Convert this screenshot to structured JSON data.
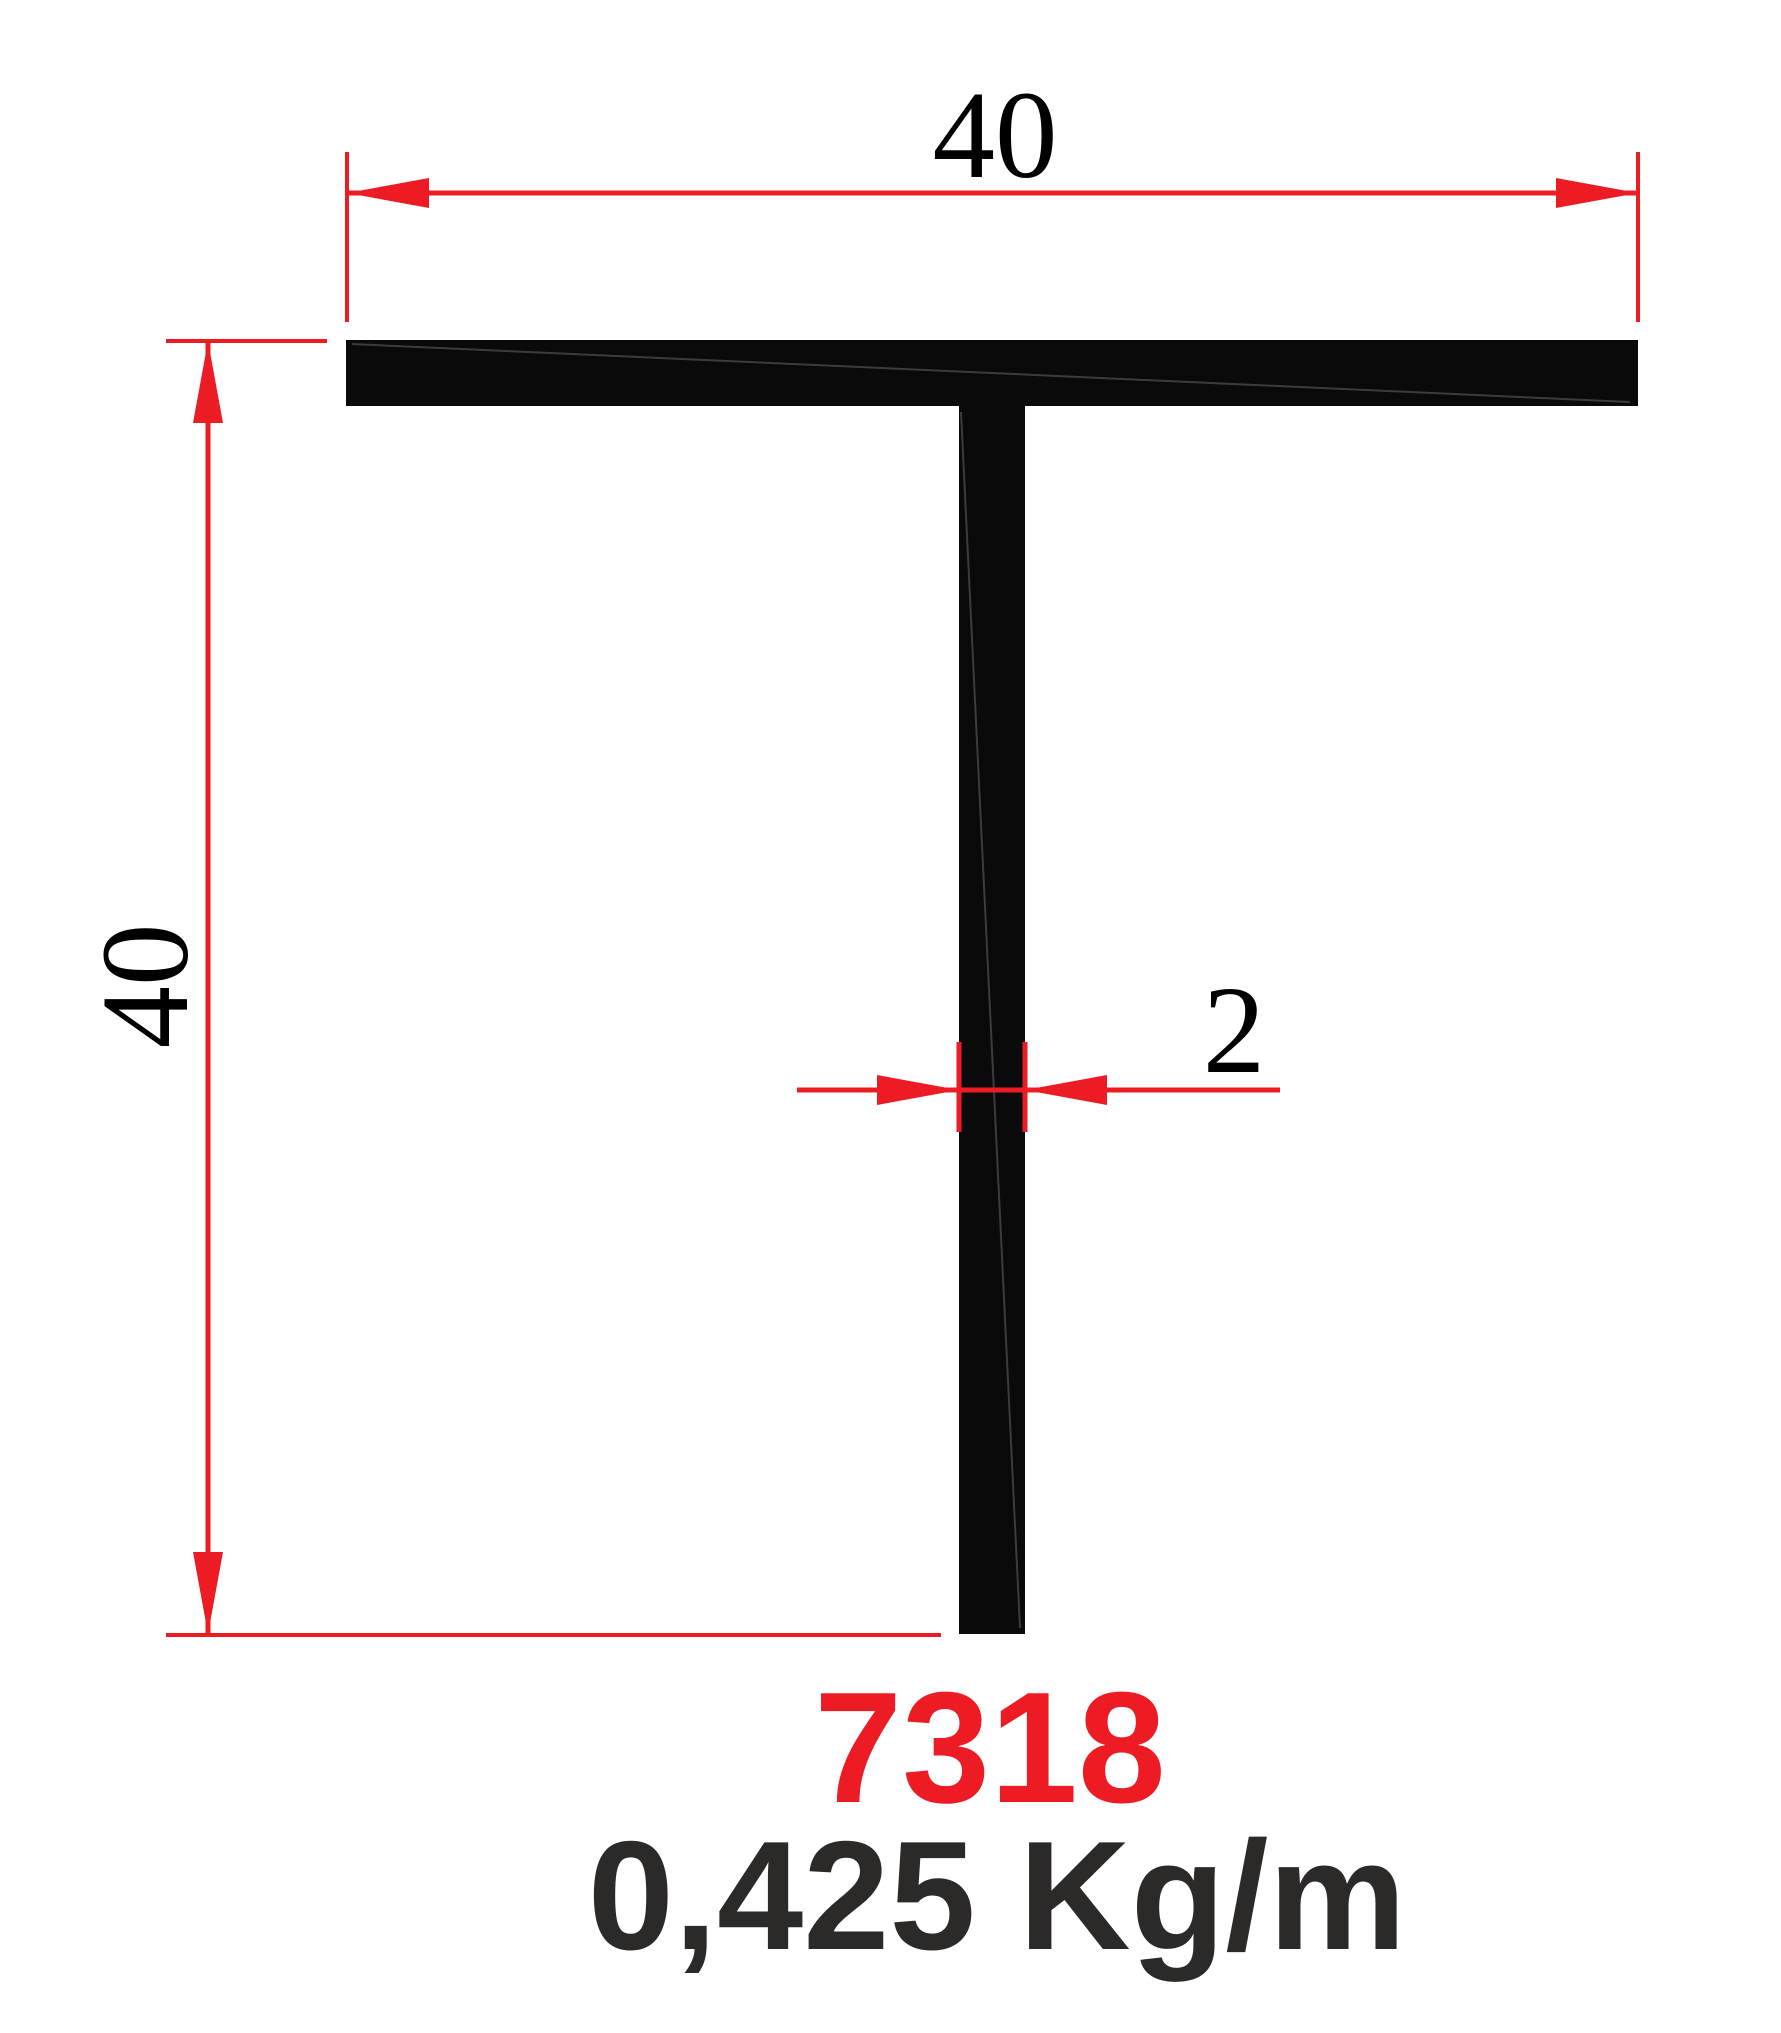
{
  "drawing": {
    "profile_code": "7318",
    "unit_weight": "0,425 Kg/m",
    "dimensions": {
      "flange_width": "40",
      "total_height": "40",
      "wall_thickness": "2"
    },
    "colors": {
      "dim_red": "#ED1C24",
      "profile_fill": "#0A0A0A",
      "dim_text": "#000000",
      "weight_text": "#2B2A29",
      "page_bg": "#FFFFFF"
    }
  }
}
